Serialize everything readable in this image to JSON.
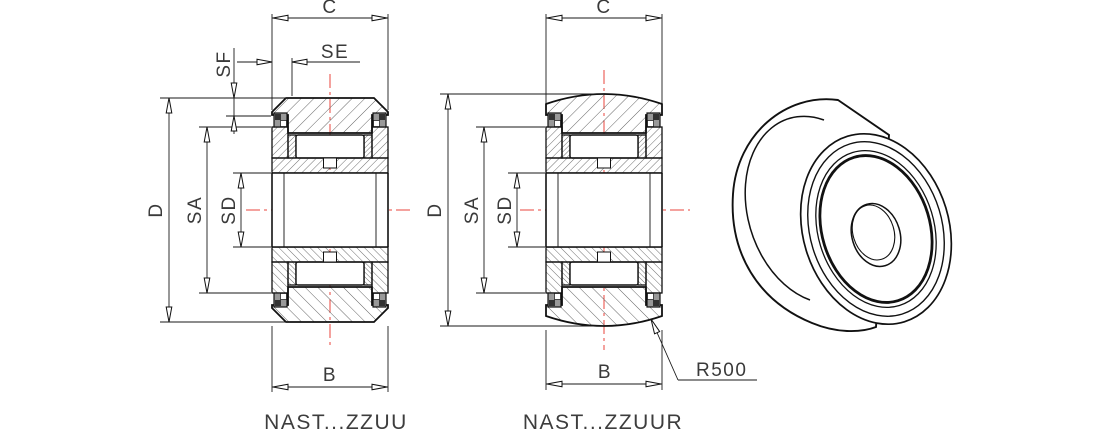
{
  "drawing": {
    "title": "roller-follower-bearing-drawing",
    "background": "#ffffff",
    "colors": {
      "line": "#111111",
      "centerline_red": "#e8463c",
      "hatch": "#666666",
      "text": "#3a3a3a",
      "shield_gray": "#999999",
      "shield_dark": "#333333"
    },
    "views": {
      "zzuu": {
        "caption": "NAST...ZZUU",
        "dim_c": "C",
        "dim_se": "SE",
        "dim_sf": "SF",
        "dim_d": "D",
        "dim_sa": "SA",
        "dim_sd": "SD",
        "dim_b": "B"
      },
      "zzuur": {
        "caption": "NAST...ZZUUR",
        "dim_c": "C",
        "dim_d": "D",
        "dim_sa": "SA",
        "dim_sd": "SD",
        "dim_b": "B",
        "crown_radius": "R500"
      }
    }
  }
}
